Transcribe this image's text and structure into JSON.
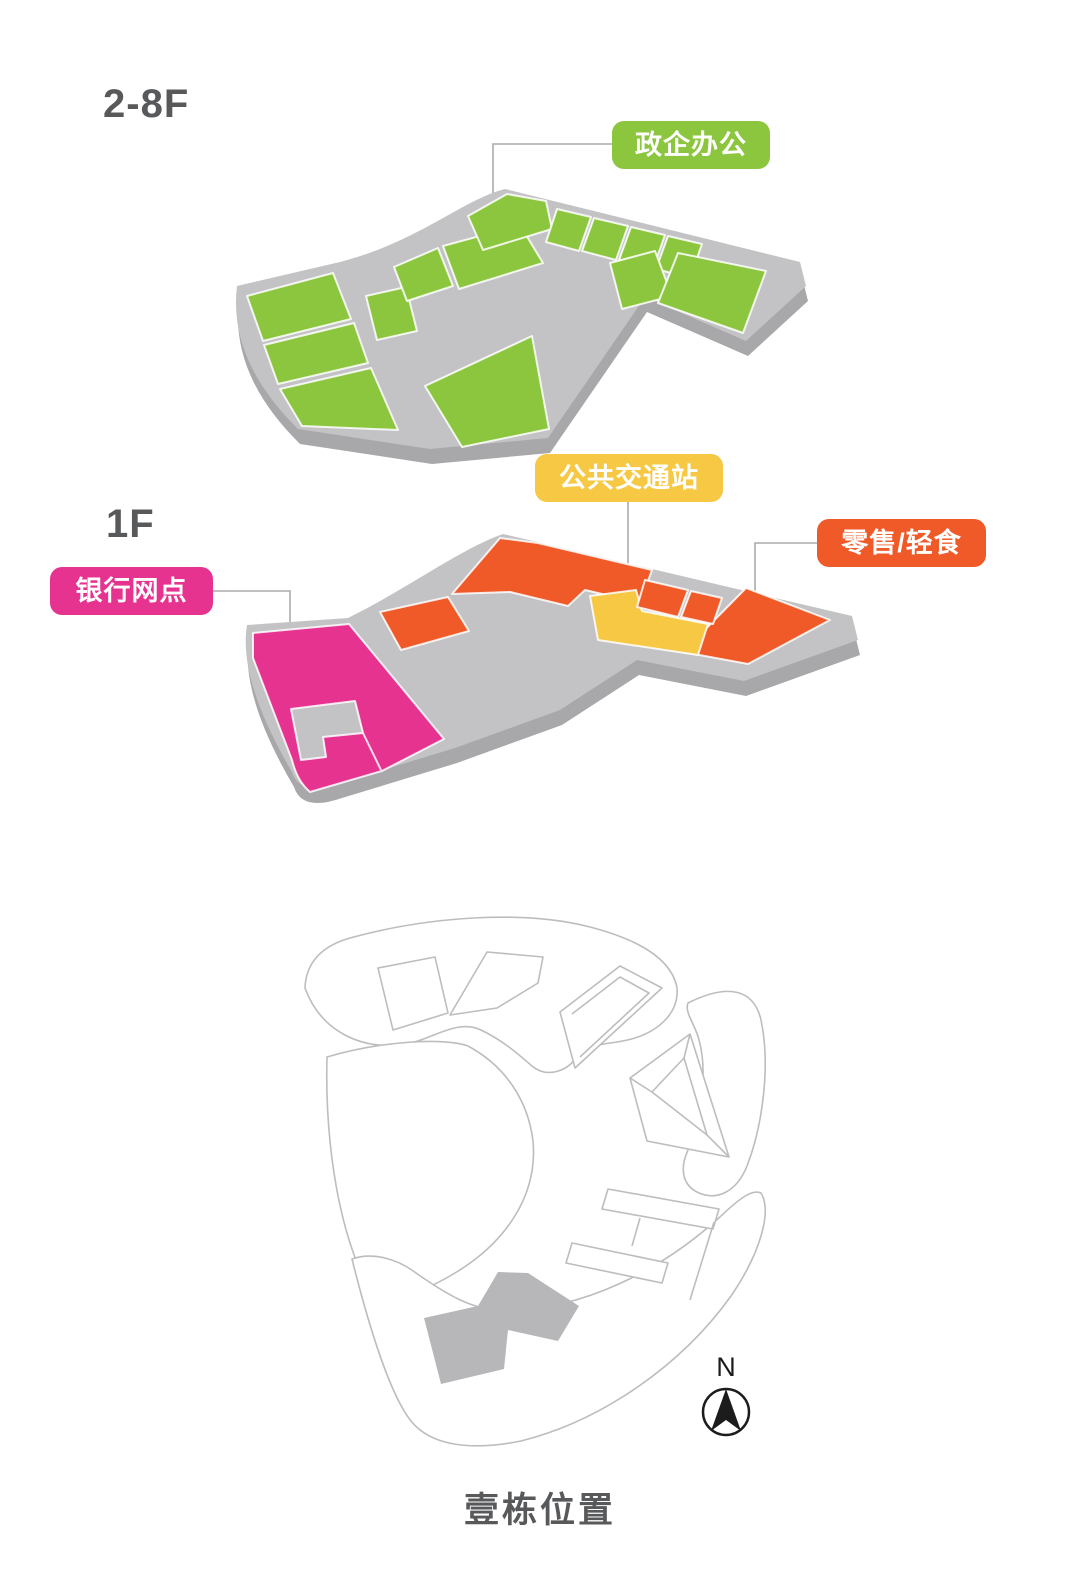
{
  "colors": {
    "office_green": "#8CC63F",
    "transit_yellow": "#F6C844",
    "bank_pink": "#E73390",
    "retail_orange": "#F05A28",
    "slab_top": "#C3C3C5",
    "slab_side": "#A8A8AA",
    "site_building": "#B7B7B9",
    "heading": "#58595B"
  },
  "upper_floor": {
    "title": "2-8F",
    "zone_label": "政企办公"
  },
  "first_floor": {
    "title": "1F",
    "labels": {
      "transit": "公共交通站",
      "bank": "银行网点",
      "retail": "零售/轻食"
    }
  },
  "legend": [
    {
      "floor": "2-8F",
      "label": "政企办公",
      "color": "#8CC63F"
    },
    {
      "floor": "1F",
      "label": "公共交通站",
      "color": "#F6C844"
    },
    {
      "floor": "1F",
      "label": "银行网点",
      "color": "#E73390"
    },
    {
      "floor": "1F",
      "label": "零售/轻食",
      "color": "#F05A28"
    }
  ],
  "site_plan": {
    "title": "壹栋位置",
    "compass": "N"
  }
}
